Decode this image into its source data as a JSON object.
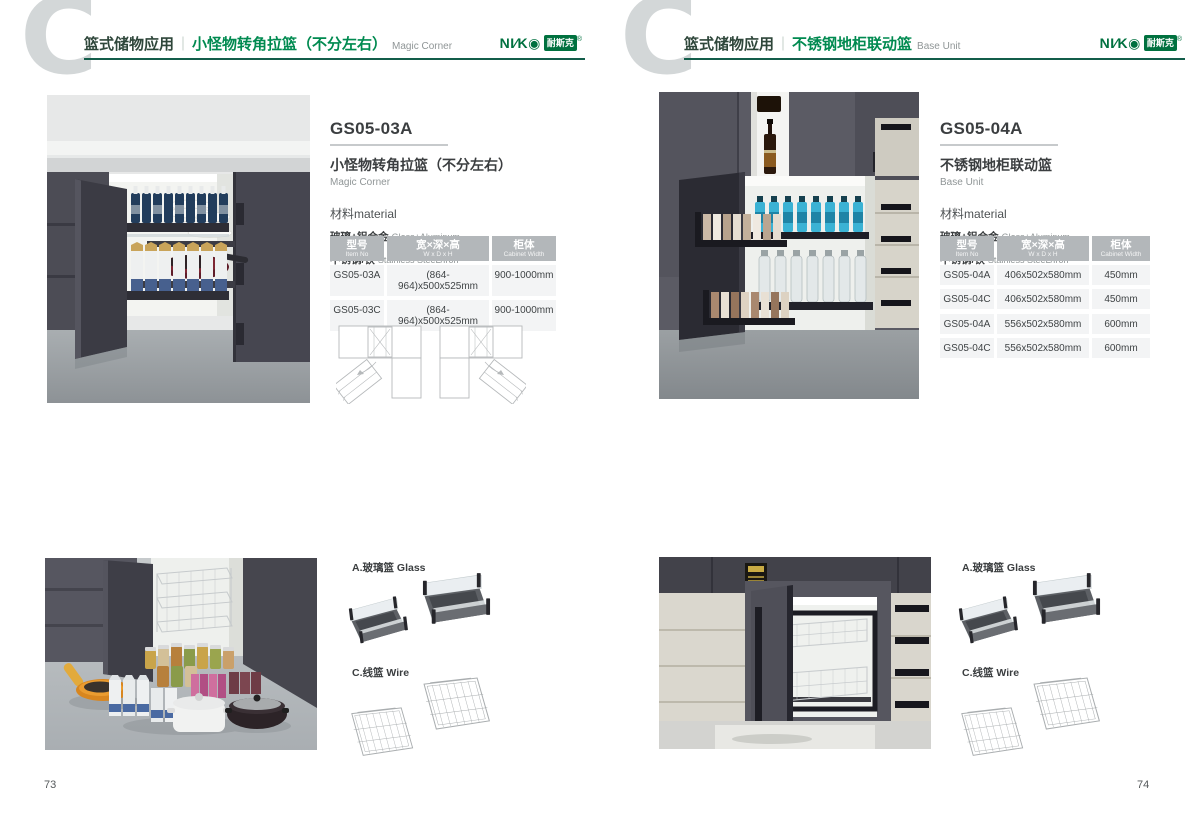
{
  "brand": {
    "logo_latin": "NI∕K◉",
    "logo_cn": "耐斯克",
    "registered": "®",
    "green": "#00713f",
    "accent_line": "#135d4a",
    "table_header_gray": "#b3b7ba"
  },
  "left_page": {
    "page_number": "73",
    "header": {
      "watermark": "C",
      "category": "篮式储物应用",
      "divider": "｜",
      "title_cn": "小怪物转角拉篮（不分左右）",
      "title_en": "Magic Corner"
    },
    "product": {
      "model": "GS05-03A",
      "name_cn": "小怪物转角拉篮（不分左右）",
      "name_en": "Magic Corner",
      "material_heading": "材料material",
      "materials": [
        {
          "cn": "玻璃+铝合金",
          "en": "Glass+Aluminum"
        },
        {
          "cn": "不锈钢/铁",
          "en": "Stainless SteeL/Iron"
        }
      ]
    },
    "table": {
      "headers": [
        {
          "cn": "型号",
          "en": "Item No"
        },
        {
          "cn": "宽×深×高",
          "en": "W x D x H"
        },
        {
          "cn": "柜体",
          "en": "Cabinet Width"
        }
      ],
      "rows": [
        [
          "GS05-03A",
          "(864-964)x500x525mm",
          "900-1000mm"
        ],
        [
          "GS05-03C",
          "(864-964)x500x525mm",
          "900-1000mm"
        ]
      ]
    },
    "legend": {
      "glass": "A.玻璃篮 Glass",
      "wire": "C.线篮 Wire"
    }
  },
  "right_page": {
    "page_number": "74",
    "header": {
      "watermark": "C",
      "category": "篮式储物应用",
      "divider": "｜",
      "title_cn": "不锈钢地柜联动篮",
      "title_en": "Base Unit"
    },
    "product": {
      "model": "GS05-04A",
      "name_cn": "不锈钢地柜联动篮",
      "name_en": "Base Unit",
      "material_heading": "材料material",
      "materials": [
        {
          "cn": "玻璃+铝合金",
          "en": "Glass+Aluminum"
        },
        {
          "cn": "不锈钢/铁",
          "en": "Stainless SteeL/Iron"
        }
      ]
    },
    "table": {
      "headers": [
        {
          "cn": "型号",
          "en": "Item No"
        },
        {
          "cn": "宽×深×高",
          "en": "W x D x H"
        },
        {
          "cn": "柜体",
          "en": "Cabinet Width"
        }
      ],
      "rows": [
        [
          "GS05-04A",
          "406x502x580mm",
          "450mm"
        ],
        [
          "GS05-04C",
          "406x502x580mm",
          "450mm"
        ],
        [
          "GS05-04A",
          "556x502x580mm",
          "600mm"
        ],
        [
          "GS05-04C",
          "556x502x580mm",
          "600mm"
        ]
      ]
    },
    "legend": {
      "glass": "A.玻璃篮 Glass",
      "wire": "C.线篮 Wire"
    }
  }
}
